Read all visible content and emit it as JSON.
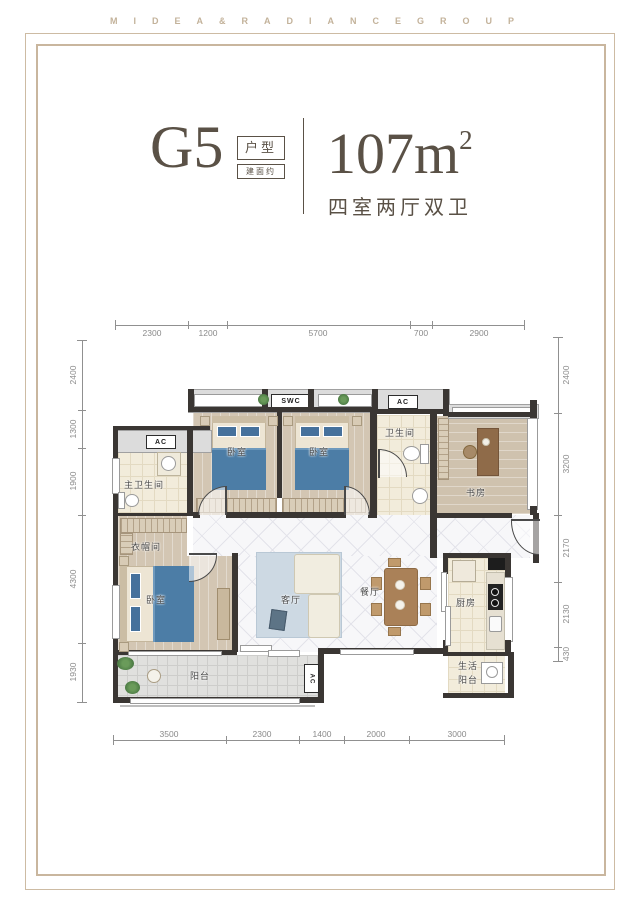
{
  "brand": {
    "letters": "MIDEA&RADIANCEGROUP"
  },
  "title": {
    "plan_code": "G5",
    "tag_type": "户型",
    "tag_area_note": "建面约",
    "area": "107m",
    "area_sup": "2",
    "layout_desc": "四室两厅双卫"
  },
  "badges": {
    "swc": "SWC",
    "ac": "AC"
  },
  "rooms": {
    "master_bath": "主卫生间",
    "cloakroom": "衣帽间",
    "bedroom": "卧室",
    "bathroom": "卫生间",
    "study": "书房",
    "living": "客厅",
    "dining": "餐厅",
    "kitchen": "厨房",
    "balcony": "阳台",
    "service_balcony_line1": "生活",
    "service_balcony_line2": "阳台"
  },
  "dims": {
    "top": [
      "2300",
      "1200",
      "5700",
      "700",
      "2900"
    ],
    "left": [
      "2400",
      "1300",
      "1900",
      "4300",
      "1930"
    ],
    "right": [
      "2400",
      "3200",
      "2170",
      "2130",
      "430"
    ],
    "bottom": [
      "3500",
      "2300",
      "1400",
      "2000",
      "3000"
    ]
  },
  "colors": {
    "accent_gold": "#c9b69e",
    "ink": "#5a5146",
    "wall": "#3a3633",
    "bed_blue": "#4c7da6"
  }
}
